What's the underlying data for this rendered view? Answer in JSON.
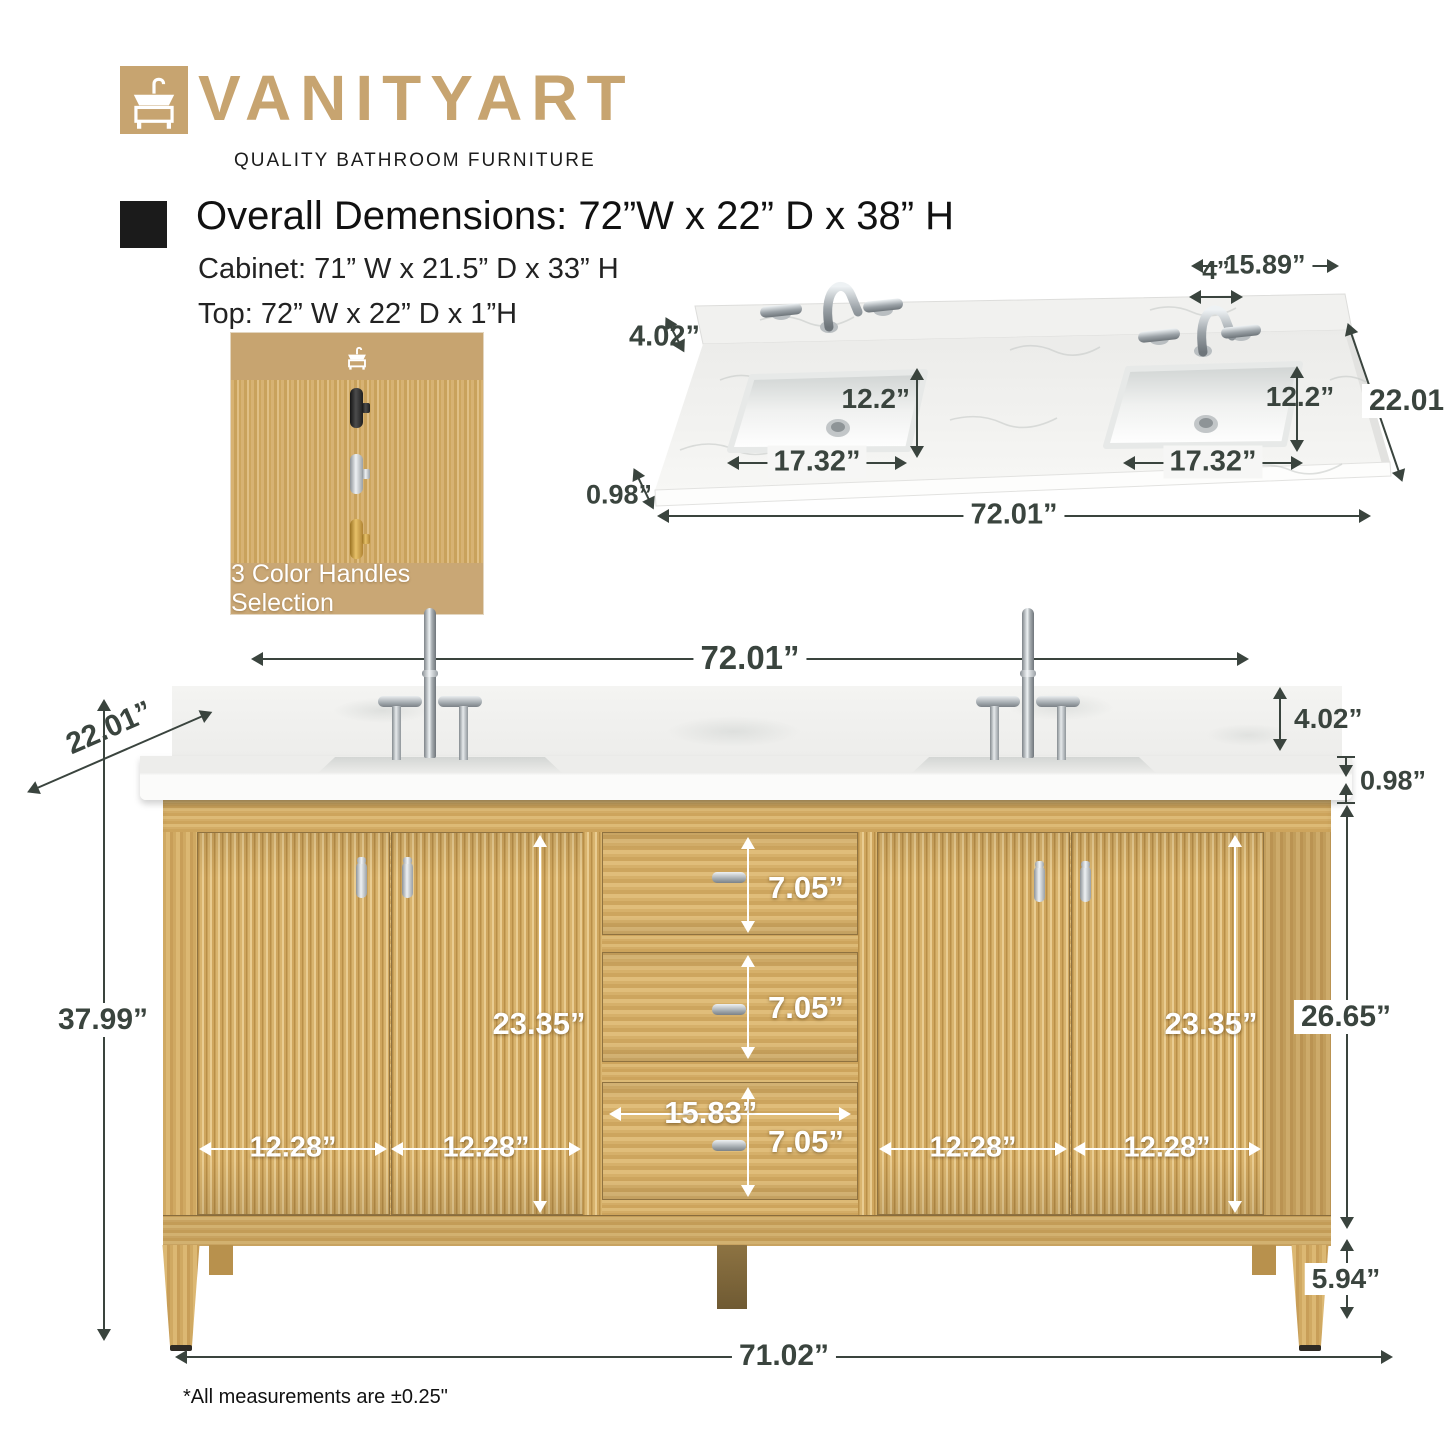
{
  "brand": {
    "name": "VANITYART",
    "tagline": "QUALITY BATHROOM FURNITURE"
  },
  "specs": {
    "overall": "Overall Demensions: 72”W x 22” D x 38” H",
    "cabinet": "Cabinet: 71” W x 21.5” D x 33” H",
    "top": "Top: 72” W x 22” D x 1”H"
  },
  "swatch": {
    "caption": "3 Color Handles Selection",
    "handle_finishes": [
      "black",
      "chrome",
      "gold"
    ]
  },
  "top_view": {
    "right_section_width": "15.89”",
    "faucet_hole_spacing": "4”",
    "backsplash_height": "4.02”",
    "left_sink_depth": "12.2”",
    "right_sink_depth": "12.2”",
    "left_sink_width": "17.32”",
    "right_sink_width": "17.32”",
    "counter_depth": "22.01”",
    "counter_thickness": "0.98”",
    "counter_width": "72.01”"
  },
  "front_view": {
    "top_width": "72.01”",
    "depth": "22.01”",
    "backsplash_height": "4.02”",
    "counter_thickness": "0.98”",
    "left_door_opening_height": "23.35”",
    "right_door_opening_height": "23.35”",
    "drawer1_height": "7.05”",
    "drawer2_height": "7.05”",
    "drawer3_height": "7.05”",
    "drawer_width": "15.83”",
    "door1_width": "12.28”",
    "door2_width": "12.28”",
    "door3_width": "12.28”",
    "door4_width": "12.28”",
    "overall_height": "37.99”",
    "cabinet_body_height": "26.65”",
    "leg_height": "5.94”",
    "base_width": "71.02”"
  },
  "footnote": "*All measurements are ±0.25\"",
  "icons": {
    "logo_mark": "vanity-sink-icon",
    "swatch_mark": "vanity-sink-icon"
  },
  "colors": {
    "brand_tan": "#C7A470",
    "dimension_text": "#3A443E",
    "wood": "#D5AF6A",
    "marble": "#F3F3F1",
    "white_label": "#FFFFFF"
  }
}
